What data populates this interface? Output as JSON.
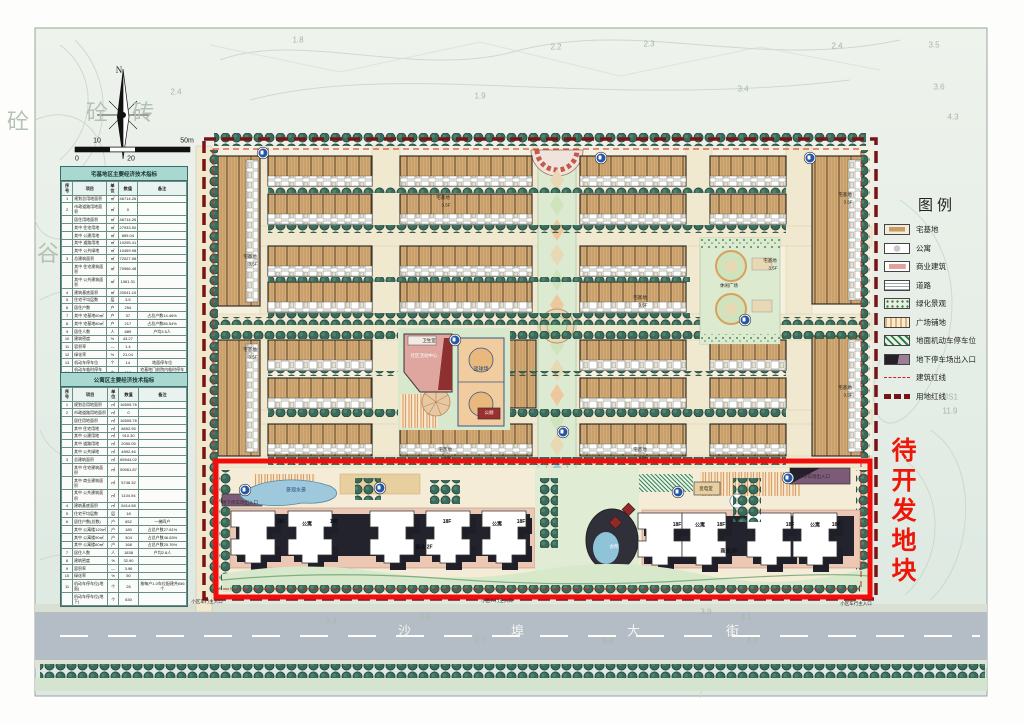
{
  "colors": {
    "redline_box": "#f20d0d",
    "site_redline": "#7a1414",
    "building_redline": "#cc2222",
    "roof_tan": "#d4ab77",
    "tree_green": "#3a6b5c",
    "street_gray": "#b4bdc5",
    "water": "#9ec9dc",
    "table_title_bg": "#a8d8d0"
  },
  "legend": {
    "title": "图例",
    "items": [
      "宅基地",
      "公寓",
      "商业建筑",
      "道路",
      "绿化景观",
      "广场铺地",
      "地面机动车停车位",
      "地下停车场出入口",
      "建筑红线",
      "用地红线"
    ]
  },
  "tables": [
    {
      "title": "宅基地区主要经济技术指标",
      "columns": [
        "序号",
        "项目",
        "单位",
        "数值",
        "备注"
      ],
      "rows": [
        [
          "1",
          "规划总用地面积",
          "㎡",
          "46714.26",
          ""
        ],
        [
          "2",
          "市政道路用地面积",
          "㎡",
          "0",
          ""
        ],
        [
          "",
          "居住用地面积",
          "㎡",
          "46714.26",
          ""
        ],
        [
          "",
          "其中 住宅用地",
          "㎡",
          "27933.50",
          ""
        ],
        [
          "",
          "其中 公建用地",
          "㎡",
          "859.04",
          ""
        ],
        [
          "",
          "其中 道路用地",
          "㎡",
          "10295.41",
          ""
        ],
        [
          "",
          "其中 公共绿地",
          "㎡",
          "10459.98",
          ""
        ],
        [
          "3",
          "总建筑面积",
          "㎡",
          "72027.98",
          ""
        ],
        [
          "",
          "其中 住宅建筑面积",
          "㎡",
          "70966.48",
          ""
        ],
        [
          "",
          "其中 公共建筑面积",
          "㎡",
          "1061.31",
          ""
        ],
        [
          "4",
          "建筑基底面积",
          "㎡",
          "20041.10",
          ""
        ],
        [
          "5",
          "住宅平均层数",
          "层",
          "3.5",
          ""
        ],
        [
          "6",
          "居住户数",
          "户",
          "254",
          ""
        ],
        [
          "7",
          "其中 宅基地60㎡",
          "户",
          "37",
          "占总户数14.46%"
        ],
        [
          "8",
          "其中 宅基地80㎡",
          "户",
          "217",
          "占总户数85.54%"
        ],
        [
          "9",
          "居住人数",
          "人",
          "889",
          "户均3.5人"
        ],
        [
          "10",
          "建筑密度",
          "%",
          "43.27",
          ""
        ],
        [
          "11",
          "容积率",
          "—",
          "1.4",
          ""
        ],
        [
          "12",
          "绿化率",
          "%",
          "21.04",
          ""
        ],
        [
          "13",
          "机动车停车位",
          "个",
          "14",
          "地面停车位"
        ],
        [
          "14",
          "机动车临时停车位",
          "个",
          "112",
          "宅基地门前院内临时停车位"
        ]
      ]
    },
    {
      "title": "公寓区主要经济技术指标",
      "columns": [
        "序号",
        "项目",
        "单位",
        "数值",
        "备注"
      ],
      "rows": [
        [
          "1",
          "规划总用地面积",
          "㎡",
          "16505.76",
          ""
        ],
        [
          "2",
          "市政道路用地面积",
          "㎡",
          "0",
          ""
        ],
        [
          "",
          "居住用地面积",
          "㎡",
          "16505.76",
          ""
        ],
        [
          "",
          "其中 住宅用地",
          "㎡",
          "8652.95",
          ""
        ],
        [
          "",
          "其中 公建用地",
          "㎡",
          "910.30",
          ""
        ],
        [
          "",
          "其中 道路用地",
          "㎡",
          "2050.05",
          ""
        ],
        [
          "",
          "其中 公共绿地",
          "㎡",
          "4892.46",
          ""
        ],
        [
          "3",
          "总建筑面积",
          "㎡",
          "65944.02",
          ""
        ],
        [
          "",
          "其中 住宅建筑面积",
          "㎡",
          "59061.87",
          ""
        ],
        [
          "",
          "其中 商业建筑面积",
          "㎡",
          "5746.32",
          ""
        ],
        [
          "",
          "其中 公共建筑面积",
          "㎡",
          "1104.94",
          ""
        ],
        [
          "4",
          "建筑基底面积",
          "㎡",
          "5414.58",
          ""
        ],
        [
          "5",
          "住宅平均层数",
          "层",
          "18",
          ""
        ],
        [
          "6",
          "居住户数(总数)",
          "户",
          "652",
          "一梯四户"
        ],
        [
          "",
          "其中 公寓楼120㎡",
          "户",
          "180",
          "占总户数27.61%"
        ],
        [
          "",
          "其中 公寓楼90㎡",
          "户",
          "304",
          "占总户数46.63%"
        ],
        [
          "",
          "其中 公寓楼60㎡",
          "户",
          "168",
          "占总户数25.76%"
        ],
        [
          "7",
          "居住人数",
          "人",
          "1838",
          "户均2.8人"
        ],
        [
          "8",
          "建筑密度",
          "%",
          "32.90",
          ""
        ],
        [
          "9",
          "容积率",
          "—",
          "3.96",
          ""
        ],
        [
          "10",
          "绿化率",
          "%",
          "50",
          ""
        ],
        [
          "11",
          "机动车停车位(地面)",
          "个",
          "26",
          "按每户1.0车位配建共656个"
        ],
        [
          "",
          "机动车停车位(地下)",
          "个",
          "630",
          ""
        ]
      ]
    }
  ],
  "plan": {
    "street_name": "沙埠大街",
    "development_note": "待开发地块",
    "markers": [
      {
        "x": 263,
        "y": 153
      },
      {
        "x": 601,
        "y": 158
      },
      {
        "x": 810,
        "y": 158
      },
      {
        "x": 455,
        "y": 340
      },
      {
        "x": 745,
        "y": 320
      },
      {
        "x": 563,
        "y": 432
      },
      {
        "x": 245,
        "y": 490
      },
      {
        "x": 380,
        "y": 488
      },
      {
        "x": 678,
        "y": 492
      },
      {
        "x": 788,
        "y": 478
      }
    ],
    "labels": [
      {
        "t": "宅基地",
        "x": 443,
        "y": 198,
        "c": "h"
      },
      {
        "t": "3.5F",
        "x": 446,
        "y": 205,
        "c": "h"
      },
      {
        "t": "宅基地",
        "x": 845,
        "y": 195,
        "c": "h"
      },
      {
        "t": "3.5F",
        "x": 848,
        "y": 202,
        "c": "h"
      },
      {
        "t": "宅基地",
        "x": 250,
        "y": 257,
        "c": "h"
      },
      {
        "t": "3.5F",
        "x": 253,
        "y": 264,
        "c": "h"
      },
      {
        "t": "宅基地",
        "x": 770,
        "y": 261,
        "c": "h"
      },
      {
        "t": "3.5F",
        "x": 773,
        "y": 268,
        "c": "h"
      },
      {
        "t": "宅基地",
        "x": 640,
        "y": 298,
        "c": "h"
      },
      {
        "t": "3.5F",
        "x": 643,
        "y": 305,
        "c": "h"
      },
      {
        "t": "宅基地",
        "x": 250,
        "y": 350,
        "c": "h"
      },
      {
        "t": "3.5F",
        "x": 253,
        "y": 357,
        "c": "h"
      },
      {
        "t": "宅基地",
        "x": 845,
        "y": 388,
        "c": "h"
      },
      {
        "t": "3.5F",
        "x": 848,
        "y": 395,
        "c": "h"
      },
      {
        "t": "宅基地",
        "x": 445,
        "y": 450,
        "c": "h"
      },
      {
        "t": "3.5F",
        "x": 448,
        "y": 457,
        "c": "h"
      },
      {
        "t": "宅基地",
        "x": 640,
        "y": 450,
        "c": "h"
      },
      {
        "t": "3.5F",
        "x": 643,
        "y": 457,
        "c": "h"
      },
      {
        "t": "卫生室",
        "x": 429,
        "y": 341,
        "c": "h",
        "n": "clinic-label"
      },
      {
        "t": "社区活动中心",
        "x": 424,
        "y": 356,
        "c": "w",
        "n": "community-center-label"
      },
      {
        "t": "篮球场",
        "x": 481,
        "y": 369,
        "c": "b",
        "n": "basketball-court-label"
      },
      {
        "t": "公厕",
        "x": 489,
        "y": 413,
        "c": "w",
        "n": "public-toilet-label"
      },
      {
        "t": "休闲广场",
        "x": 729,
        "y": 286,
        "c": "h",
        "n": "leisure-plaza-label"
      },
      {
        "t": "景观水景",
        "x": 296,
        "y": 490,
        "c": "b",
        "n": "water-feature-label"
      },
      {
        "t": "会所",
        "x": 614,
        "y": 547,
        "c": "w",
        "n": "clubhouse-label"
      },
      {
        "t": "变电室",
        "x": 706,
        "y": 489,
        "c": "h",
        "n": "substation-label"
      },
      {
        "t": "地下停车场出入口",
        "x": 240,
        "y": 503,
        "c": "e",
        "n": "underground-parking-entrance-label"
      },
      {
        "t": "地下停车场出入口",
        "x": 812,
        "y": 477,
        "c": "e",
        "n": "underground-parking-entrance-label"
      },
      {
        "t": "18F",
        "x": 281,
        "y": 522,
        "c": "t"
      },
      {
        "t": "公寓",
        "x": 307,
        "y": 524,
        "c": "t"
      },
      {
        "t": "18F",
        "x": 334,
        "y": 522,
        "c": "t"
      },
      {
        "t": "18F",
        "x": 447,
        "y": 522,
        "c": "t"
      },
      {
        "t": "公寓",
        "x": 497,
        "y": 524,
        "c": "t"
      },
      {
        "t": "18F",
        "x": 521,
        "y": 522,
        "c": "t"
      },
      {
        "t": "18F",
        "x": 677,
        "y": 525,
        "c": "t"
      },
      {
        "t": "公寓",
        "x": 700,
        "y": 525,
        "c": "t"
      },
      {
        "t": "18F",
        "x": 721,
        "y": 525,
        "c": "t"
      },
      {
        "t": "18F",
        "x": 790,
        "y": 525,
        "c": "t"
      },
      {
        "t": "公寓",
        "x": 815,
        "y": 525,
        "c": "t"
      },
      {
        "t": "18F",
        "x": 836,
        "y": 525,
        "c": "t"
      },
      {
        "t": "商业 2F",
        "x": 424,
        "y": 547,
        "c": "t",
        "n": "commercial-label"
      },
      {
        "t": "商业 2F",
        "x": 729,
        "y": 551,
        "c": "t",
        "n": "commercial-label"
      },
      {
        "t": "小区车行主入口",
        "x": 207,
        "y": 602,
        "c": "e",
        "n": "vehicle-entrance-label"
      },
      {
        "t": "小区人行主入口",
        "x": 497,
        "y": 601,
        "c": "e",
        "n": "pedestrian-entrance-label"
      },
      {
        "t": "小区车行主入口",
        "x": 856,
        "y": 604,
        "c": "e",
        "n": "vehicle-entrance-label"
      },
      {
        "t": "沙",
        "x": 405,
        "y": 630,
        "c": "s",
        "n": "street-name-char"
      },
      {
        "t": "埠",
        "x": 518,
        "y": 630,
        "c": "s",
        "n": "street-name-char"
      },
      {
        "t": "大",
        "x": 634,
        "y": 630,
        "c": "s",
        "n": "street-name-char"
      },
      {
        "t": "街",
        "x": 733,
        "y": 630,
        "c": "s",
        "n": "street-name-char"
      },
      {
        "t": "待开发地块",
        "x": 901,
        "y": 512,
        "c": "v",
        "n": "development-note"
      },
      {
        "t": "1.8",
        "x": 298,
        "y": 40,
        "c": "f"
      },
      {
        "t": "2.4",
        "x": 176,
        "y": 92,
        "c": "f"
      },
      {
        "t": "1.9",
        "x": 480,
        "y": 96,
        "c": "f"
      },
      {
        "t": "2.2",
        "x": 556,
        "y": 47,
        "c": "f"
      },
      {
        "t": "2.3",
        "x": 649,
        "y": 44,
        "c": "f"
      },
      {
        "t": "2.4",
        "x": 837,
        "y": 46,
        "c": "f"
      },
      {
        "t": "3.5",
        "x": 934,
        "y": 45,
        "c": "f"
      },
      {
        "t": "3.4",
        "x": 743,
        "y": 89,
        "c": "f"
      },
      {
        "t": "3.6",
        "x": 939,
        "y": 87,
        "c": "f"
      },
      {
        "t": "4.3",
        "x": 953,
        "y": 117,
        "c": "f"
      },
      {
        "t": "3.3",
        "x": 331,
        "y": 621,
        "c": "f"
      },
      {
        "t": "2.6",
        "x": 425,
        "y": 617,
        "c": "f"
      },
      {
        "t": "2.7",
        "x": 480,
        "y": 641,
        "c": "f"
      },
      {
        "t": "6.8",
        "x": 608,
        "y": 641,
        "c": "f"
      },
      {
        "t": "3.9",
        "x": 706,
        "y": 612,
        "c": "f"
      },
      {
        "t": "4.1",
        "x": 746,
        "y": 617,
        "c": "f"
      },
      {
        "t": "4.2",
        "x": 752,
        "y": 641,
        "c": "f"
      },
      {
        "t": "JS1",
        "x": 951,
        "y": 397,
        "c": "f"
      },
      {
        "t": "11.9",
        "x": 950,
        "y": 411,
        "c": "f"
      },
      {
        "t": "砼",
        "x": 97,
        "y": 111,
        "c": "g"
      },
      {
        "t": "砖",
        "x": 143,
        "y": 111,
        "c": "g"
      },
      {
        "t": "谷",
        "x": 48,
        "y": 252,
        "c": "g"
      },
      {
        "t": "砼",
        "x": 18,
        "y": 120,
        "c": "g"
      },
      {
        "t": "N",
        "x": 119,
        "y": 70,
        "c": "n",
        "n": "north-label"
      },
      {
        "t": "0",
        "x": 77,
        "y": 159,
        "c": "sc",
        "n": "scale-tick"
      },
      {
        "t": "10",
        "x": 97,
        "y": 141,
        "c": "sc",
        "n": "scale-tick"
      },
      {
        "t": "20",
        "x": 131,
        "y": 159,
        "c": "sc",
        "n": "scale-tick"
      },
      {
        "t": "50m",
        "x": 187,
        "y": 141,
        "c": "sc",
        "n": "scale-tick"
      }
    ]
  }
}
